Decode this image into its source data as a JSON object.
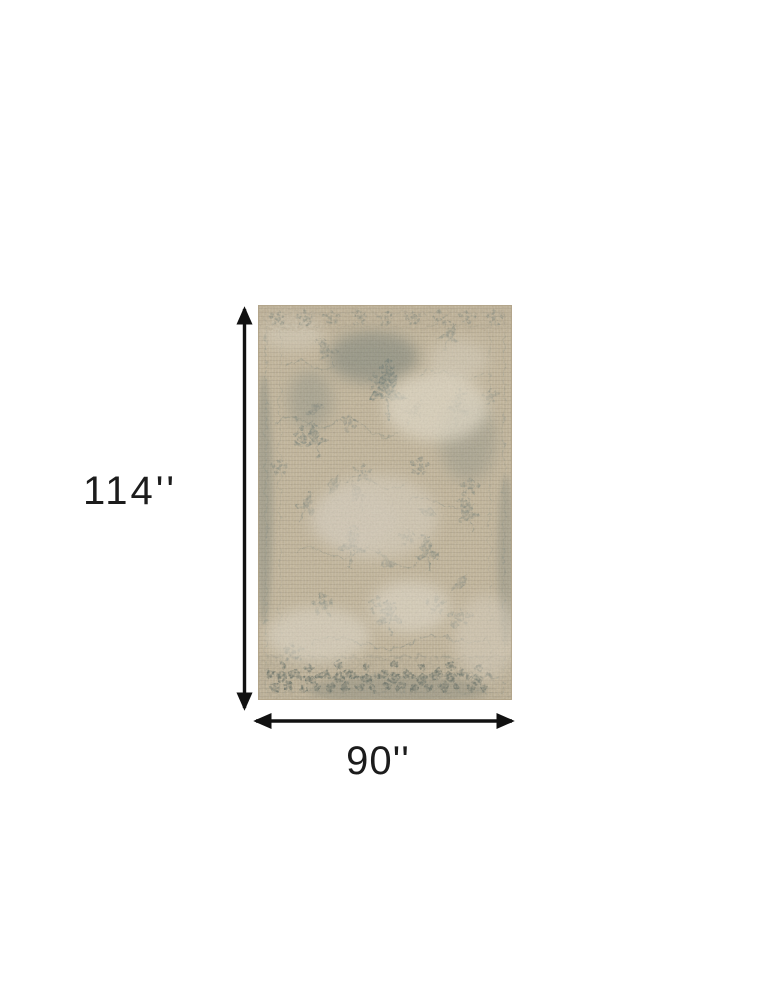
{
  "page": {
    "background_color": "#ffffff"
  },
  "diagram": {
    "height_label": "114''",
    "width_label": "90''",
    "height_value_inches": 114,
    "width_value_inches": 90,
    "arrow_color": "#111111",
    "label_color": "#1c1c1c",
    "rug": {
      "description": "beige and grey distressed vintage floral area rug",
      "base_color": "#c3b69b",
      "motif_color": "#6f7b74",
      "worn_patch_color": "#ded6c4",
      "border_line_color": "#7d887f"
    }
  }
}
